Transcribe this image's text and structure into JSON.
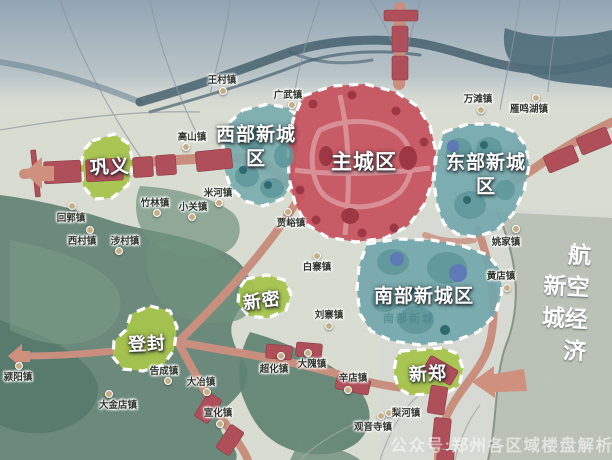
{
  "map": {
    "region": "郑州都市区划图",
    "colors": {
      "main_city_red": "#c5525e",
      "new_city_teal": "#74a8ac",
      "county_green": "#a7c44d",
      "corridor_block_red": "#ae4f5a",
      "road_salmon": "#c98f7e",
      "terrain_green": "#5f8171",
      "river_slate": "#47616f",
      "mist_blue": "#8fa3b3",
      "aviation_gray": "#a9b1a5"
    },
    "zone_labels": [
      {
        "id": "gongyi",
        "label": "巩义",
        "x": 110,
        "y": 168,
        "size": 19,
        "rotate": -3
      },
      {
        "id": "west-new-city",
        "label": "西部新城\n区",
        "x": 256,
        "y": 147,
        "size": 19,
        "rotate": 0
      },
      {
        "id": "main-city",
        "label": "主城区",
        "x": 364,
        "y": 163,
        "size": 21,
        "rotate": 0
      },
      {
        "id": "east-new-city",
        "label": "东部新城\n区",
        "x": 486,
        "y": 175,
        "size": 19,
        "rotate": 0
      },
      {
        "id": "south-new-city",
        "label": "南部新城区",
        "x": 424,
        "y": 297,
        "size": 19,
        "rotate": 0
      },
      {
        "id": "south-new-city-base",
        "label": "南部新城",
        "x": 409,
        "y": 320,
        "size": 11,
        "rotate": 0,
        "faint": true
      },
      {
        "id": "xinmi",
        "label": "新密",
        "x": 262,
        "y": 301,
        "size": 18,
        "rotate": -8
      },
      {
        "id": "dengfeng",
        "label": "登封",
        "x": 147,
        "y": 344,
        "size": 18,
        "rotate": -3
      },
      {
        "id": "xinzheng",
        "label": "新郑",
        "x": 428,
        "y": 374,
        "size": 18,
        "rotate": -3
      },
      {
        "id": "aviation-economic-new-city",
        "label": "航空经济新城",
        "x": 563,
        "y": 306,
        "size": 23,
        "rotate": 3,
        "vertical": true
      }
    ],
    "towns": [
      {
        "name": "王村镇",
        "x": 222,
        "y": 79,
        "dx": 223,
        "dy": 91
      },
      {
        "name": "广武镇",
        "x": 288,
        "y": 94,
        "dx": 292,
        "dy": 105
      },
      {
        "name": "高山镇",
        "x": 192,
        "y": 136,
        "dx": 186,
        "dy": 147
      },
      {
        "name": "米河镇",
        "x": 218,
        "y": 192,
        "dx": 219,
        "dy": 203
      },
      {
        "name": "竹林镇",
        "x": 155,
        "y": 202,
        "dx": 157,
        "dy": 213
      },
      {
        "name": "小关镇",
        "x": 193,
        "y": 206,
        "dx": 192,
        "dy": 217
      },
      {
        "name": "回郭镇",
        "x": 71,
        "y": 217,
        "dx": 72,
        "dy": 206
      },
      {
        "name": "贾峪镇",
        "x": 291,
        "y": 222,
        "dx": 288,
        "dy": 212
      },
      {
        "name": "西村镇",
        "x": 82,
        "y": 240,
        "dx": 90,
        "dy": 230
      },
      {
        "name": "涉村镇",
        "x": 125,
        "y": 240,
        "dx": 119,
        "dy": 251
      },
      {
        "name": "颍阳镇",
        "x": 18,
        "y": 376,
        "dx": 19,
        "dy": 366
      },
      {
        "name": "白寨镇",
        "x": 317,
        "y": 266,
        "dx": 317,
        "dy": 256
      },
      {
        "name": "刘寨镇",
        "x": 329,
        "y": 314,
        "dx": 329,
        "dy": 326
      },
      {
        "name": "超化镇",
        "x": 274,
        "y": 368,
        "dx": 281,
        "dy": 356
      },
      {
        "name": "大隗镇",
        "x": 312,
        "y": 363,
        "dx": 308,
        "dy": 353
      },
      {
        "name": "辛店镇",
        "x": 353,
        "y": 377,
        "dx": 348,
        "dy": 390
      },
      {
        "name": "告成镇",
        "x": 164,
        "y": 370,
        "dx": 168,
        "dy": 381
      },
      {
        "name": "大冶镇",
        "x": 201,
        "y": 381,
        "dx": 207,
        "dy": 392
      },
      {
        "name": "大金店镇",
        "x": 118,
        "y": 404,
        "dx": 109,
        "dy": 394
      },
      {
        "name": "宣化镇",
        "x": 218,
        "y": 412,
        "dx": 220,
        "dy": 424
      },
      {
        "name": "观音寺镇",
        "x": 373,
        "y": 426,
        "dx": 381,
        "dy": 416
      },
      {
        "name": "梨河镇",
        "x": 406,
        "y": 412,
        "dx": 389,
        "dy": 413
      },
      {
        "name": "万滩镇",
        "x": 478,
        "y": 98,
        "dx": 481,
        "dy": 110
      },
      {
        "name": "雁鸣湖镇",
        "x": 529,
        "y": 108,
        "dx": 536,
        "dy": 98
      },
      {
        "name": "姚家镇",
        "x": 506,
        "y": 241,
        "dx": 516,
        "dy": 229
      },
      {
        "name": "黄店镇",
        "x": 501,
        "y": 275,
        "dx": 507,
        "dy": 288
      }
    ],
    "watermark": {
      "text": "公众号:郑州各区域楼盘解析",
      "x": 502,
      "y": 444
    }
  }
}
